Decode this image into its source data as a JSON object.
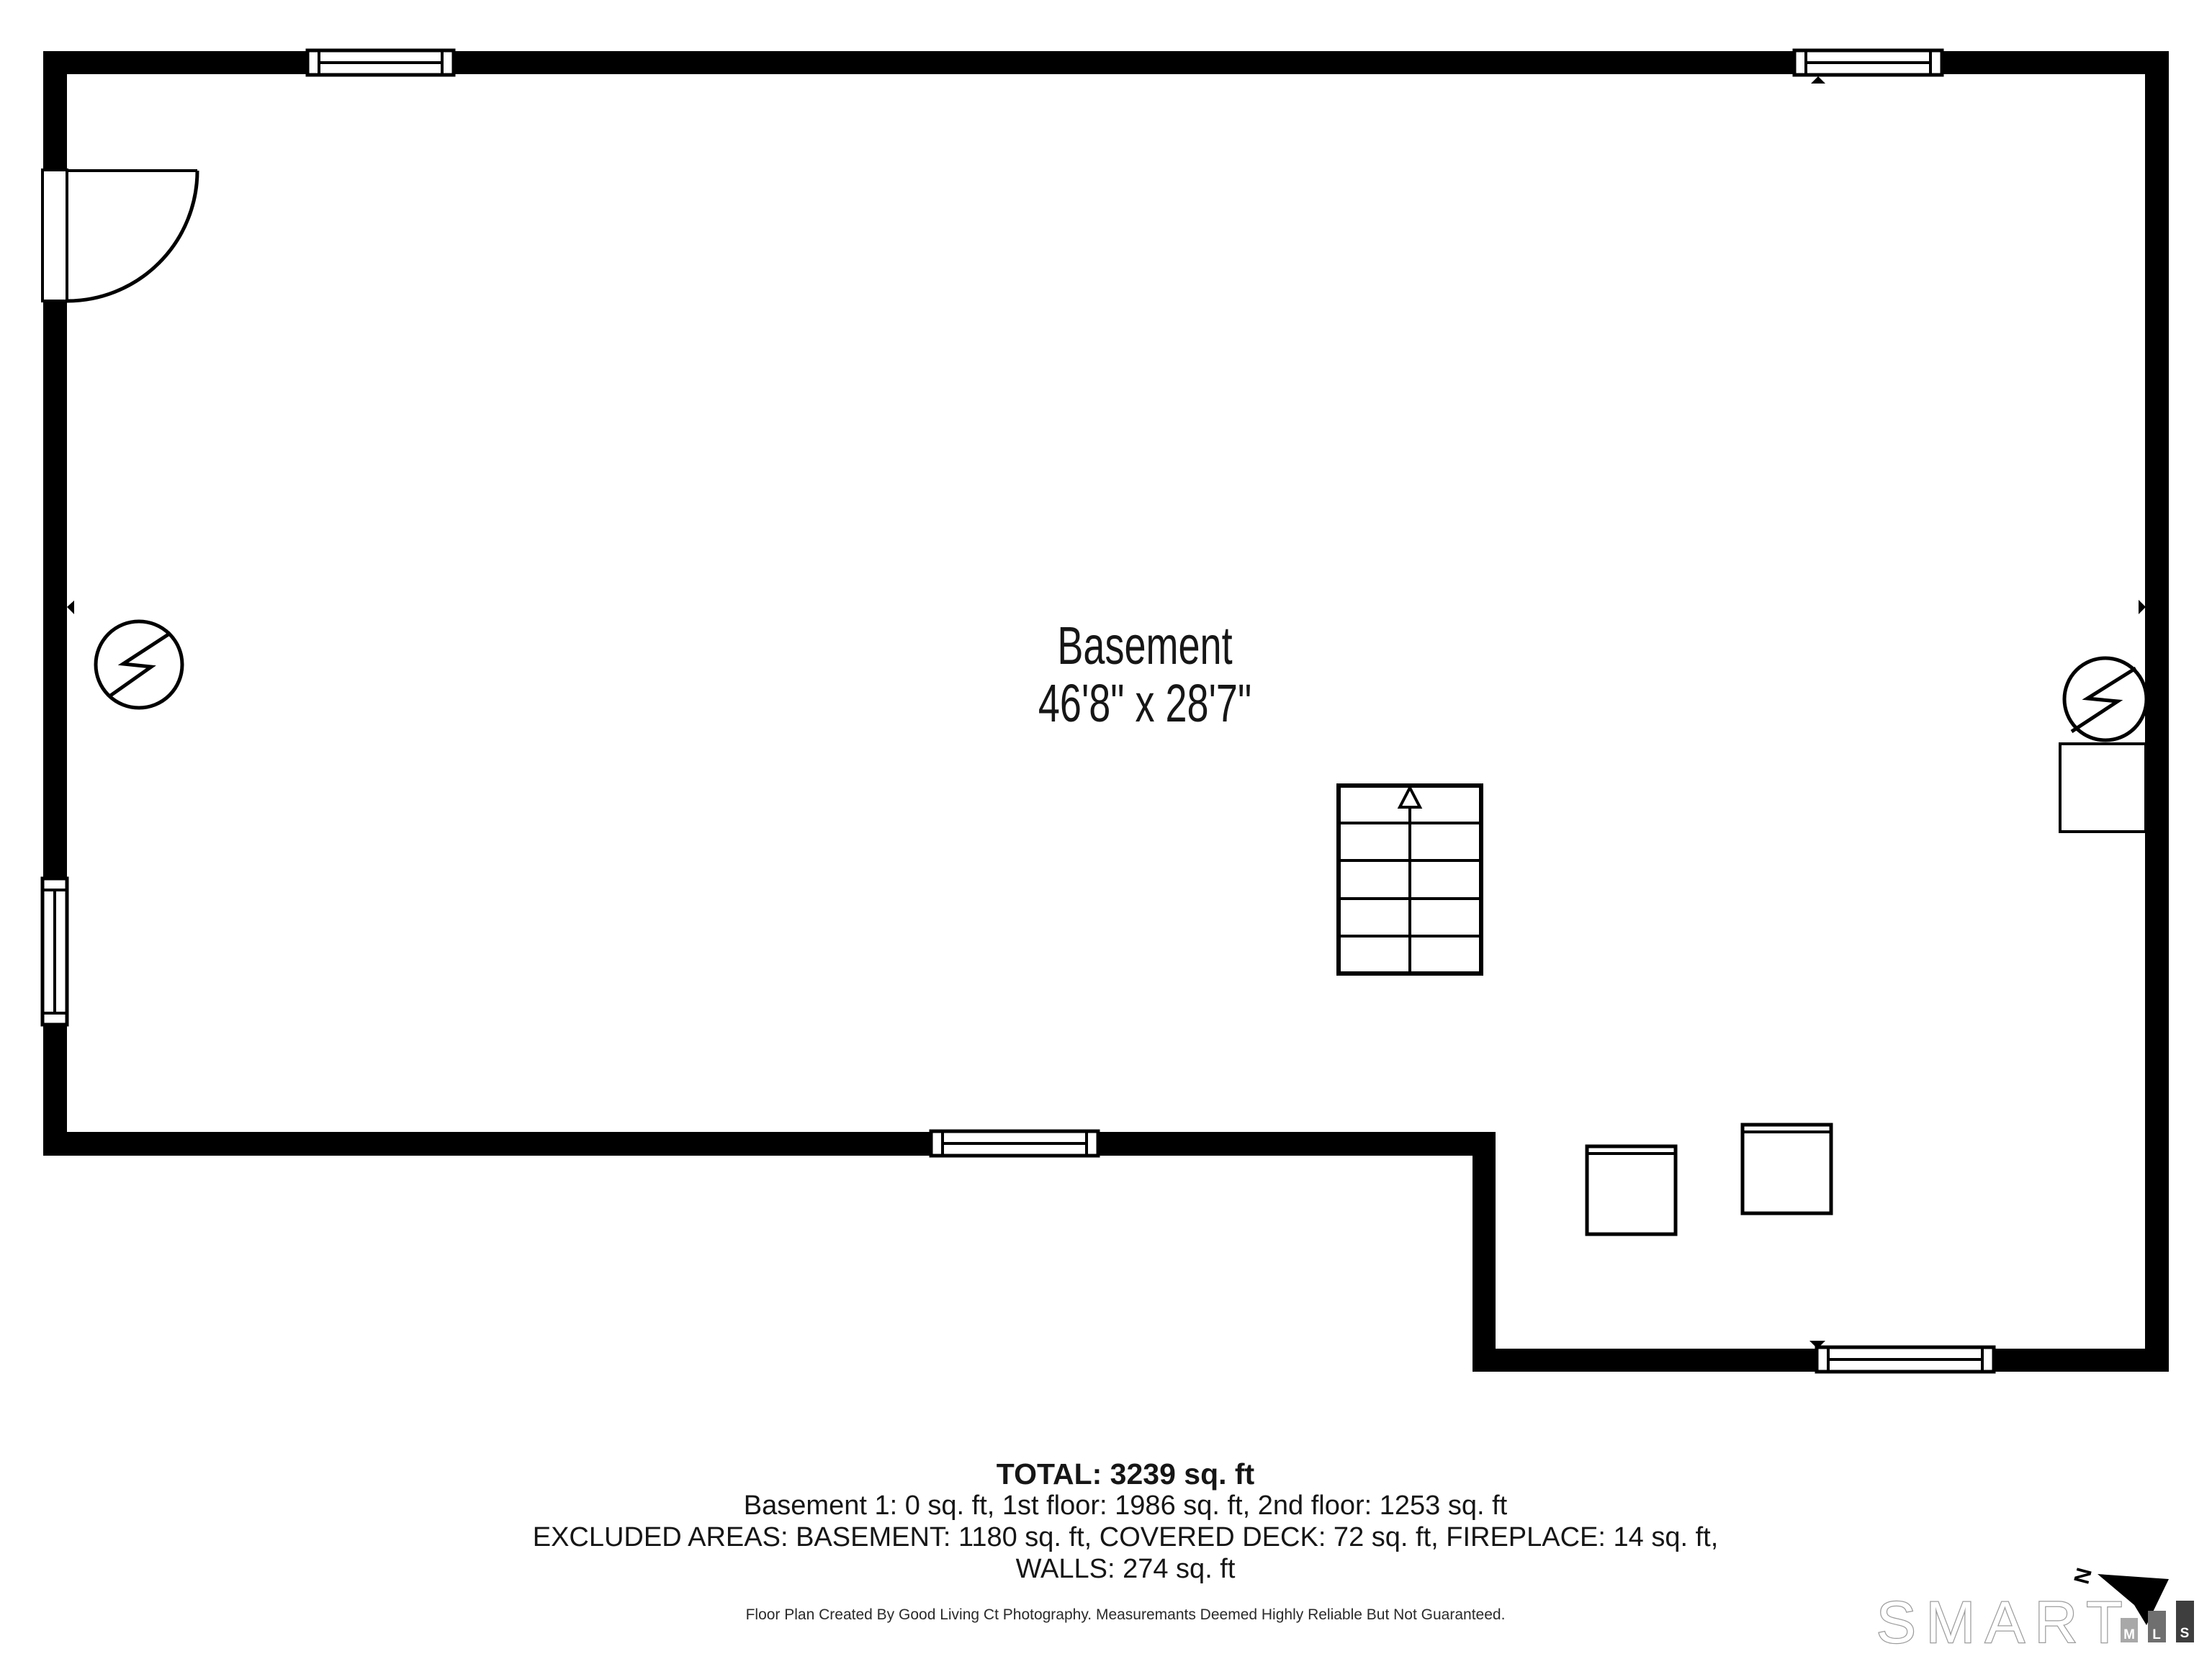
{
  "room": {
    "label": "Basement",
    "dimensions": "46'8\" x 28'7\""
  },
  "summary": {
    "total": "TOTAL: 3239 sq. ft",
    "floors": "Basement 1: 0 sq. ft, 1st floor: 1986 sq. ft, 2nd floor: 1253 sq. ft",
    "excluded_line1": "EXCLUDED AREAS: BASEMENT: 1180 sq. ft, COVERED DECK: 72 sq. ft, FIREPLACE: 14 sq. ft,",
    "excluded_line2": "WALLS: 274 sq. ft"
  },
  "disclaimer": "Floor Plan Created By Good Living Ct Photography. Measuremants Deemed Highly Reliable But Not Guaranteed.",
  "compass": {
    "label": "N"
  },
  "branding": {
    "name": "SMART",
    "wordmark_outline": "#9c9c9c",
    "bars": [
      {
        "label": "M",
        "color": "#a8a8a8"
      },
      {
        "label": "L",
        "color": "#6f6f6f"
      },
      {
        "label": "S",
        "color": "#3e3e3e"
      }
    ]
  },
  "colors": {
    "walls": "#000000",
    "background": "#ffffff"
  }
}
